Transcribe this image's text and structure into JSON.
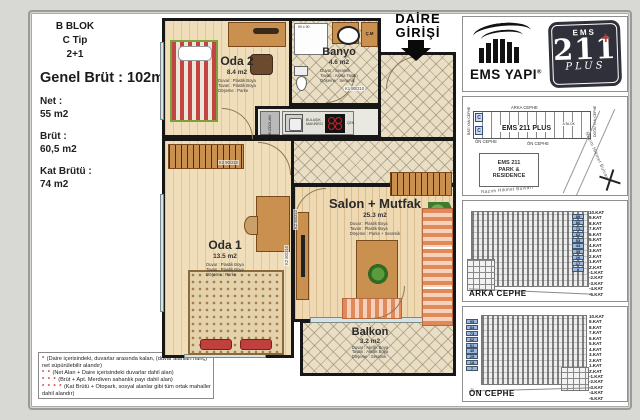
{
  "left_panel": {
    "block": "B BLOK",
    "type": "C Tip",
    "layout": "2+1",
    "genel_brut": "Genel Brüt : 102m2",
    "net_label": "Net :",
    "net_value": "55 m2",
    "brut_label": "Brüt :",
    "brut_value": "60,5 m2",
    "kat_brutu_label": "Kat Brütü :",
    "kat_brutu_value": "74 m2"
  },
  "footnotes": [
    {
      "stars": "*",
      "text": "(Daire içerisindeki, duvarlar arasında kalan, (duvar alanları hariç) net süpürülebilir alandır)"
    },
    {
      "stars": "* *",
      "text": "(Net Alan + Daire içerisindeki duvarlar dahil alan)"
    },
    {
      "stars": "* * *",
      "text": "(Brüt + Apt. Merdiven sahanlık payı dahil alan)"
    },
    {
      "stars": "* * * *",
      "text": "(Kat Brütü + Otopark, sosyal alanlar gibi tüm ortak mahaller dahil alandır)"
    }
  ],
  "entrance": {
    "line1": "DAİRE",
    "line2": "GİRİŞİ"
  },
  "rooms": {
    "oda2": {
      "name": "Oda 2",
      "area": "8.4 m2",
      "specs": [
        "Duvar : Plastik Boya",
        "Tavan : Plastik Boya",
        "Döşeme : Parke"
      ]
    },
    "banyo": {
      "name": "Banyo",
      "area": "4.6 m2",
      "specs": [
        "Duvar : Seramik",
        "Tavan : Asma Tavan",
        "Döşeme : Seramik"
      ]
    },
    "salon": {
      "name": "Salon + Mutfak",
      "area": "25.3 m2",
      "specs": [
        "Duvar : Plastik Boya",
        "Tavan : Plastik Boya",
        "Döşeme : Parke + Seramik"
      ]
    },
    "oda1": {
      "name": "Oda 1",
      "area": "13.5 m2",
      "specs": [
        "Duvar : Plastik Boya",
        "Tavan : Plastik Boya",
        "Döşeme : Parke"
      ]
    },
    "balkon": {
      "name": "Balkon",
      "area": "3.2 m2",
      "specs": [
        "Duvar : Akrilik Boya",
        "Tavan : Akrilik Boya",
        "Döşeme : Seramik"
      ]
    }
  },
  "plan_labels": {
    "shower_dim": "90 x 90",
    "washing_machine": "Ç.M",
    "fridge": "BUZDOLABI",
    "dishwasher": "BULAŞIK MAKİNESİ",
    "drawer": "ÇEK.",
    "door_k1": "K1 80/210",
    "door_k2_90": "K2 90/210",
    "door_k2_80": "K2 80/210"
  },
  "brand": {
    "company": "EMS YAPI",
    "reg": "®",
    "badge_top": "EMS",
    "badge_number": "211",
    "badge_plus": "+",
    "badge_script": "PLUS"
  },
  "site_plan": {
    "arka_cephe": "ARKA CEPHE",
    "on_cephe_1": "ÖN CEPHE",
    "on_cephe_2": "ÖN CEPHE",
    "bati": "BATI YAN CEPHE",
    "dogu": "DOĞU YAN CEPHE",
    "building": "EMS 211 PLUS",
    "a_blok": "A BLOK",
    "unit_marker": "C",
    "park_line1": "EMS 211",
    "park_line2": "PARK &",
    "park_line3": "RESIDENCE",
    "street1": "Nazım Hikmet Bulvarı",
    "street2": "Nazım Hikmet Bulvarı"
  },
  "elevations": {
    "floors": [
      "10.KAT",
      "9.KAT",
      "8.KAT",
      "7.KAT",
      "6.KAT",
      "5.KAT",
      "4.KAT",
      "3.KAT",
      "2.KAT",
      "1.KAT",
      "Z.KAT",
      "-1.KAT",
      "-2.KAT",
      "-3.KAT",
      "-4.KAT",
      "-5.KAT"
    ],
    "arka": {
      "title": "ARKA CEPHE",
      "units": [
        "89",
        "80",
        "71",
        "62",
        "53",
        "44",
        "35",
        "26",
        "17",
        "8"
      ]
    },
    "on": {
      "title": "ÖN CEPHE",
      "units": [
        "95",
        "84",
        "73",
        "62",
        "51",
        "40",
        "29",
        "18",
        "7"
      ]
    }
  },
  "colors": {
    "badge_navy": "#30303b",
    "highlight_blue": "#9db8dc",
    "asterisk_red": "#cc2233",
    "wall_black": "#171717",
    "wood_floor": "#eed9b2",
    "tile_floor": "#e9dfc7"
  }
}
